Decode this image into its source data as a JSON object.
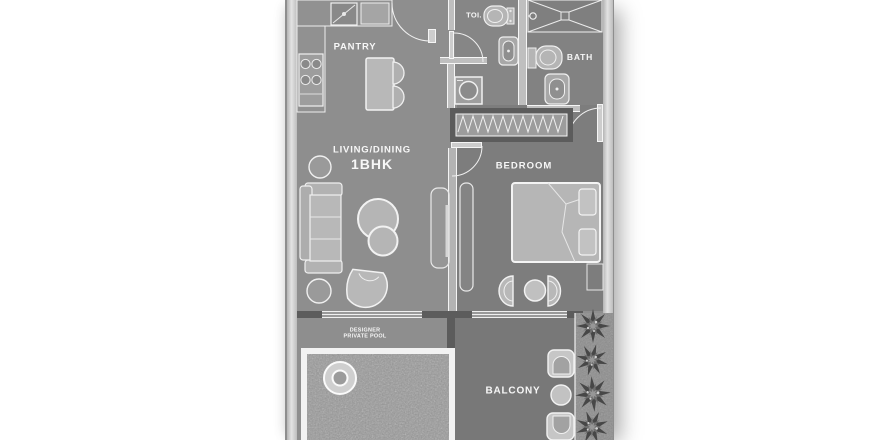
{
  "rooms": {
    "pantry": {
      "label": "PANTRY"
    },
    "toilet": {
      "label": "TOI."
    },
    "bath": {
      "label": "BATH"
    },
    "living": {
      "label": "LIVING/DINING",
      "sublabel": "1BHK"
    },
    "bedroom": {
      "label": "BEDROOM"
    },
    "pool": {
      "label_line1": "DESIGNER",
      "label_line2": "PRIVATE POOL"
    },
    "balcony": {
      "label": "BALCONY"
    }
  },
  "colors": {
    "background": "#ffffff",
    "floor_main": "#8e8e8e",
    "floor_bedroom": "#7d7d7d",
    "floor_balcony": "#787878",
    "wall_light": "#bfbfbf",
    "wall_dark": "#5c5c5c",
    "furniture_fill": "#b5b5b5",
    "furniture_outline": "#f2f2f2",
    "label_text": "#f7f7f7"
  }
}
